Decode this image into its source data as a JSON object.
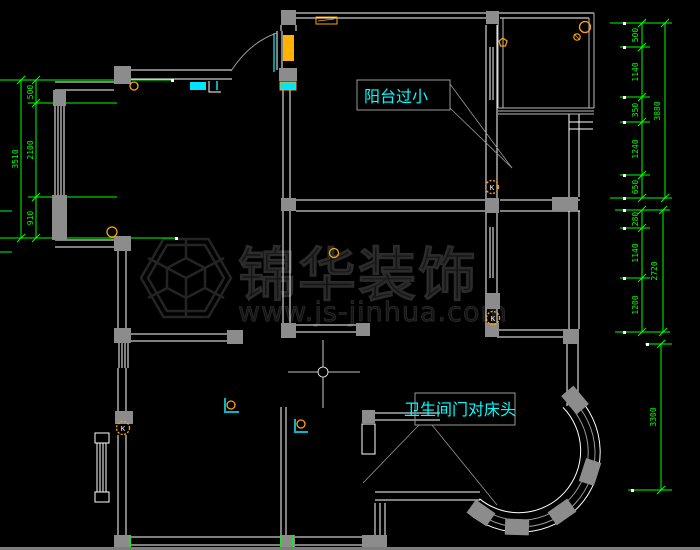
{
  "drawing": {
    "type": "apartment-floor-plan",
    "background": "#000000"
  },
  "labels": {
    "balcony_note": "阳台过小",
    "bathroom_note": "卫生间门对床头"
  },
  "watermark": {
    "brand": "锦华装饰",
    "website": "www.js-jinhua.com"
  },
  "markers": {
    "k_marker": "K"
  },
  "dimensions": {
    "left_chain": {
      "segments": [
        "500",
        "2100",
        "910"
      ],
      "total": "3510"
    },
    "right_top_chain": {
      "segments": [
        "500",
        "1140",
        "350",
        "1240",
        "650"
      ],
      "total": "3880"
    },
    "right_middle_chain": {
      "segments": [
        "280",
        "1140",
        "1200"
      ],
      "total": "2720"
    },
    "right_bottom_chain": {
      "total": "3300"
    }
  },
  "colors": {
    "walls": "#ffffff",
    "dimensions": "#00ff00",
    "annotations": "#00ffff",
    "fixtures": "#ffa500",
    "columns": "#8c8c8c",
    "watermark": "#1c1c1c"
  }
}
